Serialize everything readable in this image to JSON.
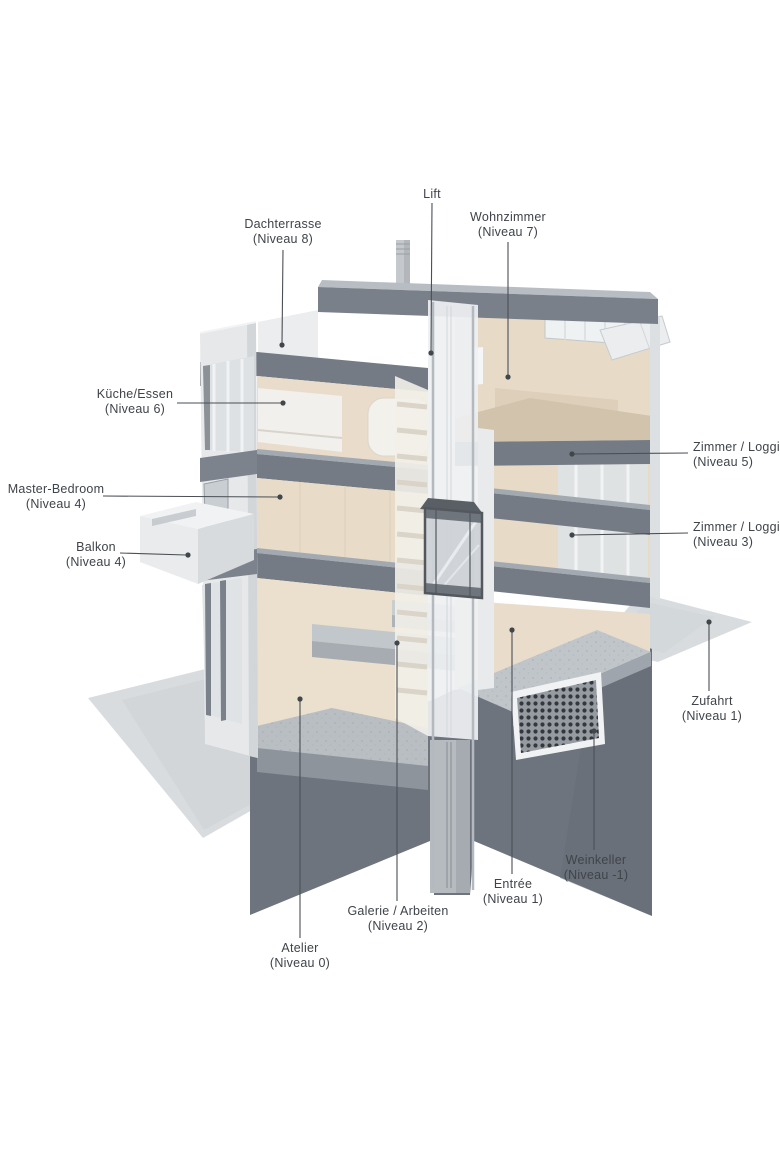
{
  "diagram": {
    "kind": "architectural cutaway section",
    "labels": [
      {
        "id": "lift",
        "title": "Lift",
        "subtitle": ""
      },
      {
        "id": "dachterrasse",
        "title": "Dachterrasse",
        "subtitle": "(Niveau 8)"
      },
      {
        "id": "wohnzimmer",
        "title": "Wohnzimmer",
        "subtitle": "(Niveau 7)"
      },
      {
        "id": "kueche",
        "title": "Küche/Essen",
        "subtitle": "(Niveau 6)"
      },
      {
        "id": "master",
        "title": "Master-Bedroom",
        "subtitle": "(Niveau 4)"
      },
      {
        "id": "balkon",
        "title": "Balkon",
        "subtitle": "(Niveau 4)"
      },
      {
        "id": "zimmer5",
        "title": "Zimmer / Loggia",
        "subtitle": "(Niveau 5)"
      },
      {
        "id": "zimmer3",
        "title": "Zimmer / Loggia",
        "subtitle": "(Niveau 3)"
      },
      {
        "id": "zufahrt",
        "title": "Zufahrt",
        "subtitle": "(Niveau 1)"
      },
      {
        "id": "weinkeller",
        "title": "Weinkeller",
        "subtitle": "(Niveau -1)"
      },
      {
        "id": "entree",
        "title": "Entrée",
        "subtitle": "(Niveau 1)"
      },
      {
        "id": "galerie",
        "title": "Galerie / Arbeiten",
        "subtitle": "(Niveau 2)"
      },
      {
        "id": "atelier",
        "title": "Atelier",
        "subtitle": "(Niveau 0)"
      }
    ],
    "colors": {
      "background": "#ffffff",
      "plinth_dark_concrete": "#6e747e",
      "slab_gray": "#757b84",
      "roof_fascia": "#7a8089",
      "interior_wall_cream": "#e9dccb",
      "exterior_wall_white": "#e7e9ea",
      "ground_plane": "#d9dcdf",
      "floor_concrete": "#b9bec3",
      "wood_floor_tan": "#d2c3ad",
      "label_text": "#3f444a",
      "leader_line": "#4a4f55"
    }
  }
}
